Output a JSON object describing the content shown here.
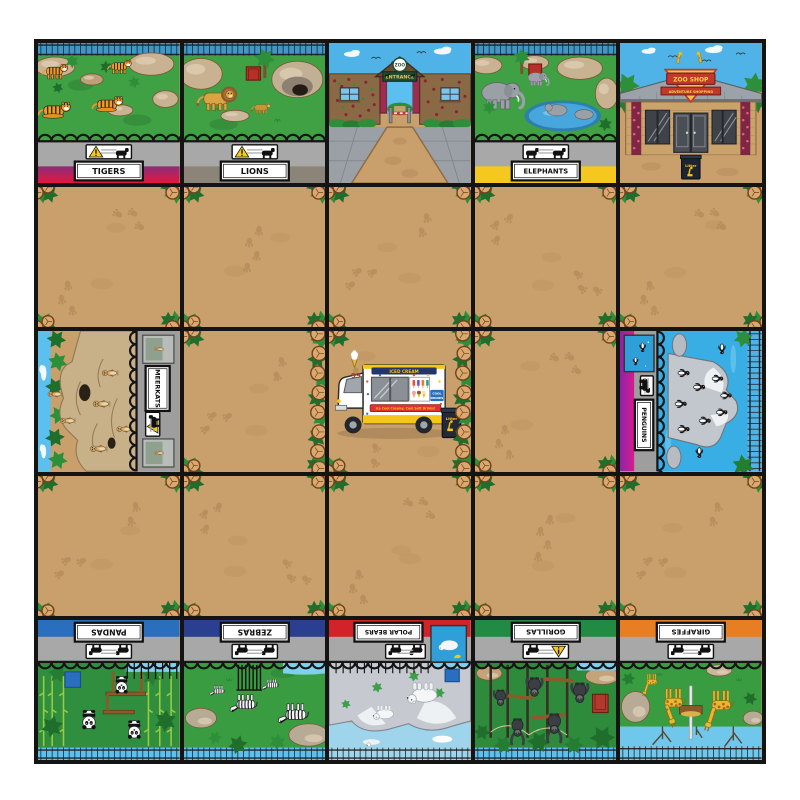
{
  "mat": {
    "rows": 5,
    "cols": 5,
    "line_color": "#141414",
    "margin_color": "#ffffff",
    "path_color": "#C9A06B"
  },
  "labels": {
    "tigers": "TIGERS",
    "lions": "LIONS",
    "elephants": "ELEPHANTS",
    "meerkats": "MEERKATS",
    "penguins": "PENGUINS",
    "pandas": "PANDAS",
    "zebras": "ZEBRAS",
    "polarbears": "POLAR BEARS",
    "gorillas": "GORILLAS",
    "giraffes": "GIRAFFES"
  },
  "signs": {
    "entrance_logo": "ZOO",
    "entrance": "ENTRANCE",
    "shop_title": "ZOO SHOP",
    "shop_banner": "ADVENTURE SHOPPING"
  },
  "van": {
    "number": "99",
    "top_sign": "ICED CREAM",
    "banner": "Ice Cool Creamy, Cool Soft Drinks!",
    "drinks_line1": "COOL",
    "drinks_line2": "DRINKS",
    "litter": "Litter"
  },
  "shop": {
    "bin_label": "Litter"
  },
  "bands": {
    "tigers": [
      "#8A2E79",
      "#E3173E"
    ],
    "lions": "#8C8478",
    "elephants": "#F6C71F",
    "pandas": "#2A6FBE",
    "zebras": "#2A3F8F",
    "polarbears": "#D2232A",
    "gorillas": "#218B44",
    "giraffes": "#E87E24",
    "penguins": [
      "#D81B8C",
      "#8E24AA"
    ]
  },
  "tiles": [
    [
      "tigers",
      "lions",
      "entrance",
      "elephants",
      "zooshop"
    ],
    [
      "path",
      "path",
      "path",
      "path",
      "path"
    ],
    [
      "meerkats",
      "path",
      "van",
      "path",
      "penguins"
    ],
    [
      "path",
      "path",
      "path",
      "path",
      "path"
    ],
    [
      "pandas",
      "zebras",
      "polarbears",
      "gorillas",
      "giraffes"
    ]
  ],
  "rotations": {
    "meerkats": -90,
    "penguins": 90,
    "pandas": 180,
    "zebras": 180,
    "polarbears": 180,
    "gorillas": 180,
    "giraffes": 180
  }
}
